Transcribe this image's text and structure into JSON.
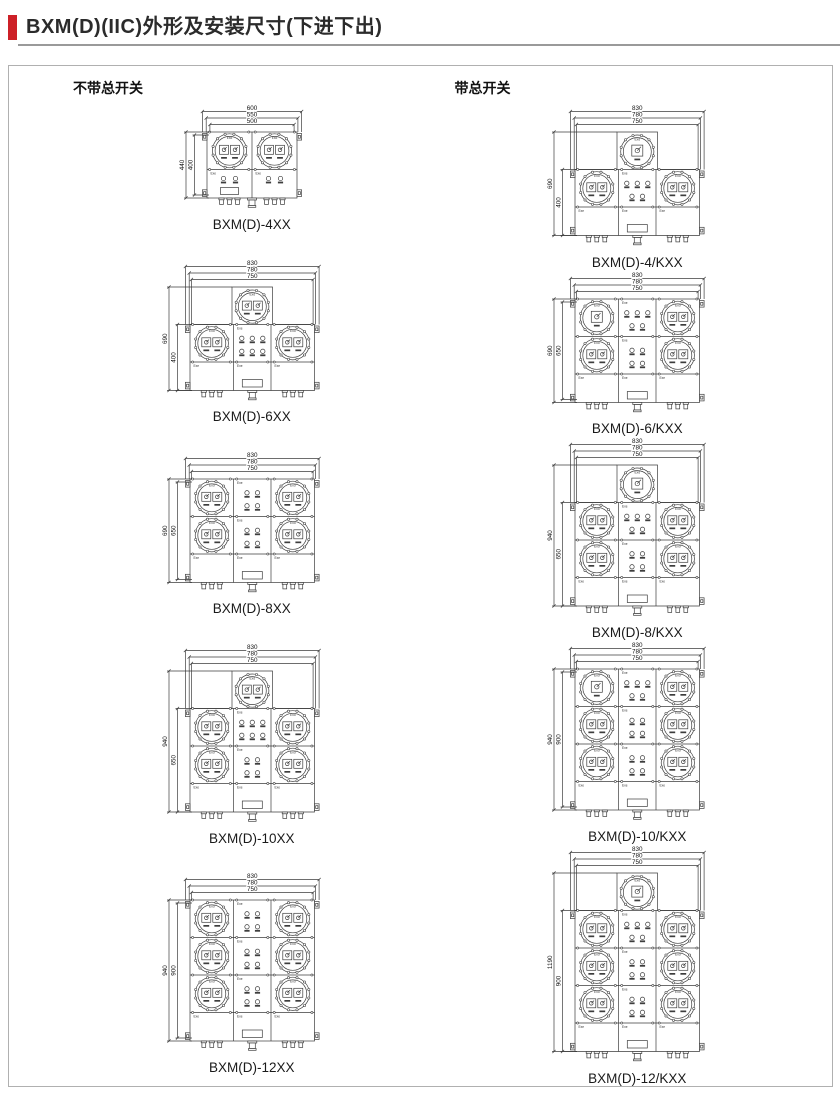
{
  "page": {
    "title": "BXM(D)(IIC)外形及安装尺寸(下进下出)",
    "accent_color": "#cd2027"
  },
  "drawing_marks": {
    "flameproof": "Exd",
    "increased_safety": "Exe"
  },
  "columns": [
    {
      "heading": "不带总开关",
      "figures": [
        {
          "caption": "BXM(D)-4XX",
          "top_dims": [
            "600",
            "550",
            "500"
          ],
          "side_dims": [
            "440",
            "400"
          ],
          "layout": {
            "shape": "rect",
            "cols": 2,
            "rows": 1,
            "main_switch": false,
            "panels": []
          }
        },
        {
          "caption": "BXM(D)-6XX",
          "top_dims": [
            "830",
            "780",
            "750"
          ],
          "side_dims": [
            "690",
            "400"
          ],
          "layout": {
            "shape": "cross",
            "cols": 3,
            "rows": 1,
            "main_switch": false,
            "panels": [
              [
                3,
                3
              ]
            ]
          }
        },
        {
          "caption": "BXM(D)-8XX",
          "top_dims": [
            "830",
            "780",
            "750"
          ],
          "side_dims": [
            "690",
            "650"
          ],
          "layout": {
            "shape": "rect",
            "cols": 3,
            "rows": 2,
            "main_switch": false,
            "panels": [
              [
                2,
                2
              ],
              [
                2,
                2
              ]
            ]
          }
        },
        {
          "caption": "BXM(D)-10XX",
          "top_dims": [
            "830",
            "780",
            "750"
          ],
          "side_dims": [
            "940",
            "650"
          ],
          "layout": {
            "shape": "cross",
            "cols": 3,
            "rows": 2,
            "main_switch": false,
            "panels": [
              [
                3,
                3
              ],
              [
                2,
                2
              ]
            ]
          }
        },
        {
          "caption": "BXM(D)-12XX",
          "top_dims": [
            "830",
            "780",
            "750"
          ],
          "side_dims": [
            "940",
            "900"
          ],
          "layout": {
            "shape": "rect",
            "cols": 3,
            "rows": 3,
            "main_switch": false,
            "panels": [
              [
                2,
                2
              ],
              [
                2,
                2
              ],
              [
                2,
                2
              ]
            ]
          }
        }
      ]
    },
    {
      "heading": "带总开关",
      "figures": [
        {
          "caption": "BXM(D)-4/KXX",
          "top_dims": [
            "830",
            "780",
            "750"
          ],
          "side_dims": [
            "690",
            "400"
          ],
          "layout": {
            "shape": "cross",
            "cols": 3,
            "rows": 1,
            "main_switch": true,
            "panels": [
              [
                3,
                2
              ]
            ]
          }
        },
        {
          "caption": "BXM(D)-6/KXX",
          "top_dims": [
            "830",
            "780",
            "750"
          ],
          "side_dims": [
            "690",
            "650"
          ],
          "layout": {
            "shape": "rect",
            "cols": 3,
            "rows": 2,
            "main_switch": true,
            "panels": [
              [
                3,
                2
              ],
              [
                2,
                2
              ]
            ]
          }
        },
        {
          "caption": "BXM(D)-8/KXX",
          "top_dims": [
            "830",
            "780",
            "750"
          ],
          "side_dims": [
            "940",
            "650"
          ],
          "layout": {
            "shape": "cross",
            "cols": 3,
            "rows": 2,
            "main_switch": true,
            "panels": [
              [
                3,
                2
              ],
              [
                2,
                2
              ]
            ]
          }
        },
        {
          "caption": "BXM(D)-10/KXX",
          "top_dims": [
            "830",
            "780",
            "750"
          ],
          "side_dims": [
            "940",
            "900"
          ],
          "layout": {
            "shape": "rect",
            "cols": 3,
            "rows": 3,
            "main_switch": true,
            "panels": [
              [
                3,
                2
              ],
              [
                2,
                2
              ],
              [
                2,
                2
              ]
            ]
          }
        },
        {
          "caption": "BXM(D)-12/KXX",
          "top_dims": [
            "830",
            "780",
            "750"
          ],
          "side_dims": [
            "1190",
            "900"
          ],
          "layout": {
            "shape": "cross",
            "cols": 3,
            "rows": 3,
            "main_switch": true,
            "panels": [
              [
                3,
                2
              ],
              [
                2,
                2
              ],
              [
                2,
                2
              ]
            ]
          }
        }
      ]
    }
  ]
}
